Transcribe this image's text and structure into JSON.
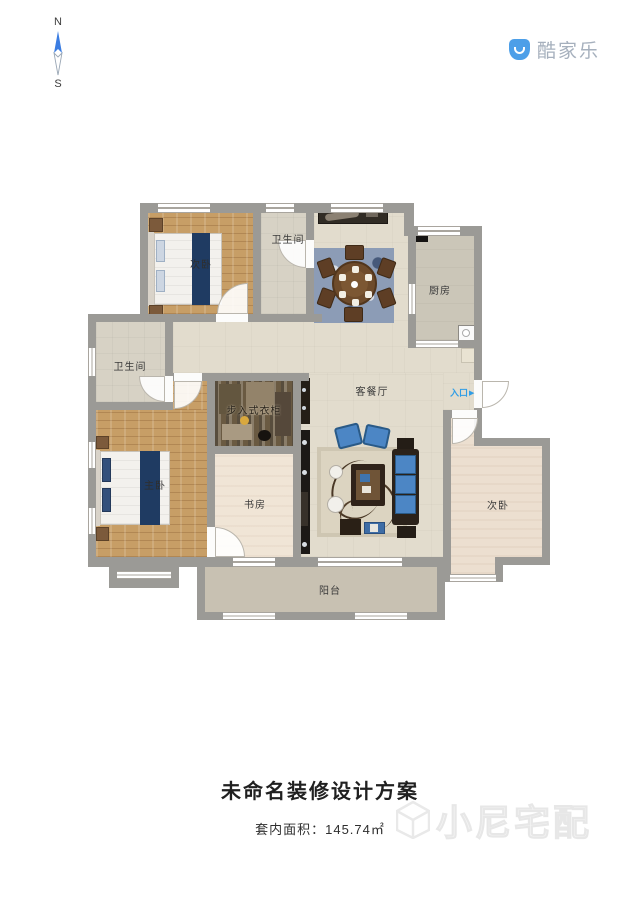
{
  "compass": {
    "north": "N",
    "south": "S"
  },
  "logo": {
    "text": "酷家乐"
  },
  "rooms": {
    "bedroom_top": {
      "label": "次卧"
    },
    "bath_top": {
      "label": "卫生间"
    },
    "kitchen": {
      "label": "厨房"
    },
    "bath_left": {
      "label": "卫生间"
    },
    "closet": {
      "label": "步入式衣柜"
    },
    "living": {
      "label": "客餐厅"
    },
    "study": {
      "label": "书房"
    },
    "master": {
      "label": "主卧"
    },
    "bedroom_right": {
      "label": "次卧"
    },
    "balcony": {
      "label": "阳台"
    }
  },
  "entrance": {
    "label": "入口",
    "arrow": "▶"
  },
  "footer": {
    "title": "未命名装修设计方案",
    "area_label": "套内面积：145.74㎡"
  },
  "watermark": {
    "text": "小尼宅配"
  },
  "colors": {
    "accent_blue": "#2f9de6",
    "wall_gray": "#9b9a96",
    "wood": "#c79e66",
    "navy_bed_runner": "#1f3b62",
    "logo_blue": "#4d9fe8",
    "sofa_blue": "#4c86c5"
  }
}
